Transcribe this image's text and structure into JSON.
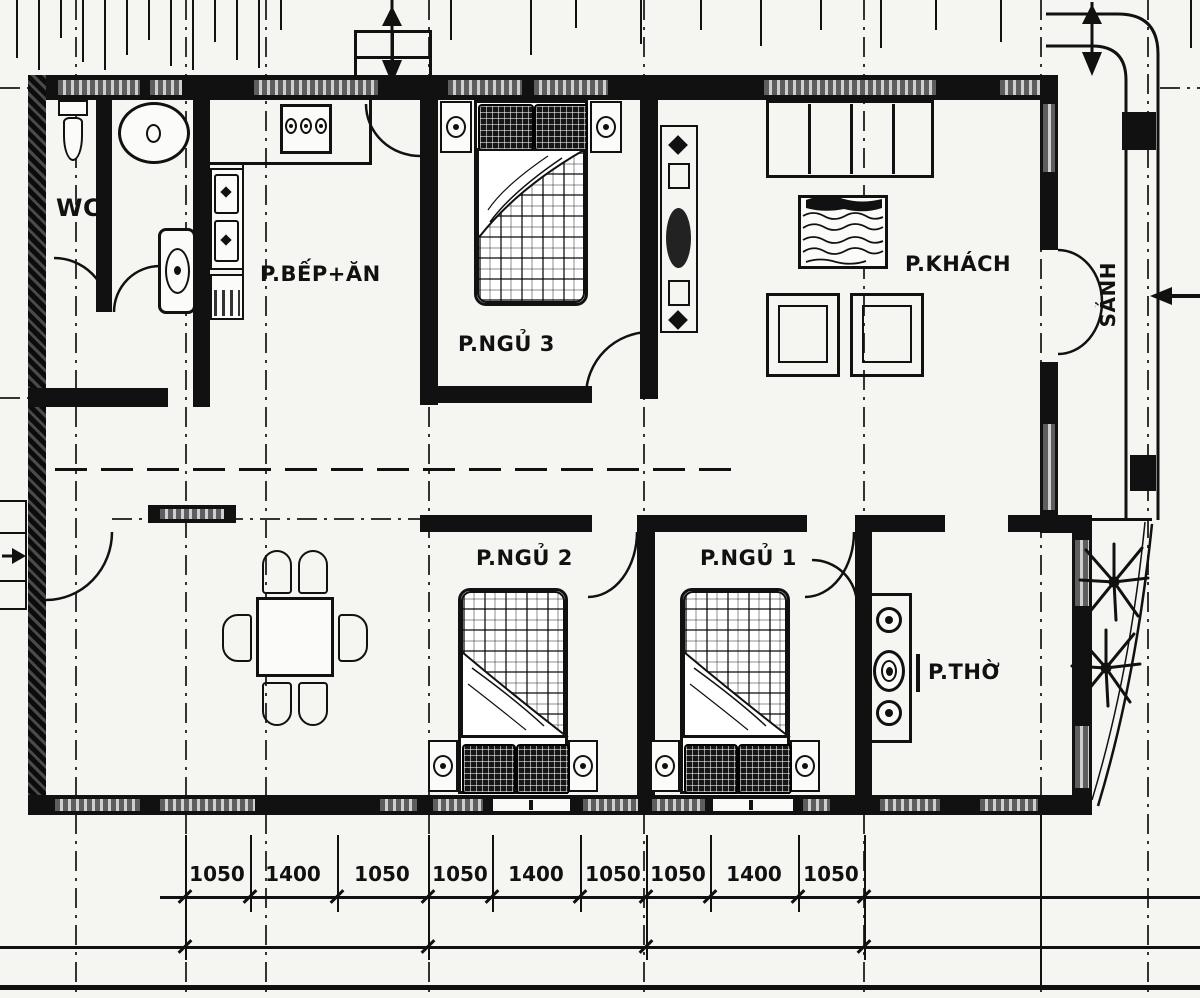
{
  "drawing": {
    "type": "house floor plan",
    "rooms": {
      "wc": "WC",
      "kitchen_dining": "P.BẾP+ĂN",
      "bedroom3": "P.NGỦ 3",
      "living": "P.KHÁCH",
      "hall": "SẢNH",
      "bedroom2": "P.NGỦ 2",
      "bedroom1": "P.NGỦ 1",
      "worship": "P.THỜ"
    },
    "dimensions_mm": [
      "1050",
      "1400",
      "1050",
      "1050",
      "1400",
      "1050",
      "1050",
      "1400",
      "1050"
    ],
    "colors": {
      "ink": "#111111",
      "paper": "#f5f5f2",
      "window_hatch": "#8f8f8f"
    }
  }
}
